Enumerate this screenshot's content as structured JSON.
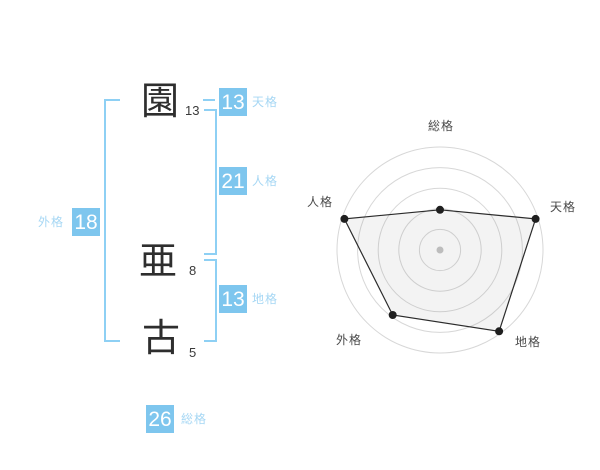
{
  "colors": {
    "box_blue": "#7EC6EE",
    "label_blue": "#A6D7F4",
    "bracket_blue": "#8ED0F4",
    "kanji_color": "#2E2E2E",
    "stroke_count_color": "#3A3A3A",
    "box_value_color": "#FFFFFF"
  },
  "name_diagram": {
    "characters": [
      {
        "char": "園",
        "strokes": "13"
      },
      {
        "char": "亜",
        "strokes": "8"
      },
      {
        "char": "古",
        "strokes": "5"
      }
    ],
    "tenkaku": {
      "value": "13",
      "label": "天格"
    },
    "jinkaku": {
      "value": "21",
      "label": "人格"
    },
    "chikaku": {
      "value": "13",
      "label": "地格"
    },
    "gaikaku": {
      "value": "18",
      "label": "外格"
    },
    "soukaku": {
      "value": "26",
      "label": "総格"
    }
  },
  "chart_data": {
    "type": "radar",
    "title": "",
    "axes": [
      "総格",
      "天格",
      "地格",
      "外格",
      "人格"
    ],
    "angles_deg": [
      90,
      18,
      -54,
      -126,
      162
    ],
    "values": [
      2,
      5,
      5,
      4,
      5
    ],
    "max": 5,
    "rings": 5,
    "grid": "concentric-circles",
    "legend": "none",
    "colors": {
      "ring": "#D7D7D7",
      "line": "#2B2B2B",
      "point": "#1F1F1F",
      "fill": "rgba(120,120,120,0.09)",
      "center_dot": "#BDBDBD",
      "label": "#4A4A4A"
    }
  }
}
